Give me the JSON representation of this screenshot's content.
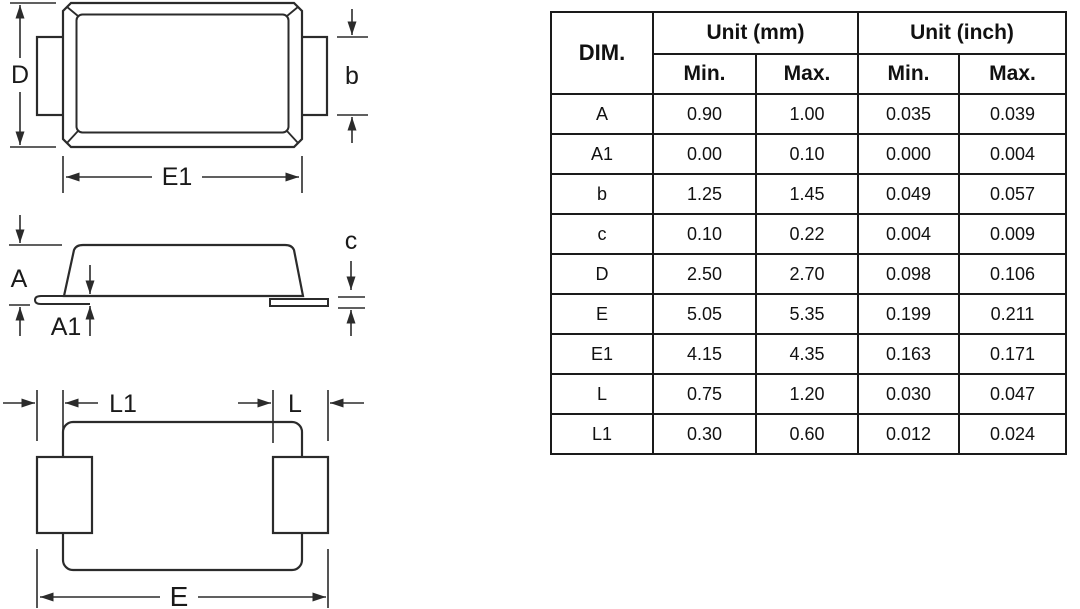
{
  "colors": {
    "line": "#2b2b2b",
    "text": "#1a1a1a",
    "background": "#ffffff"
  },
  "views": {
    "top": {
      "label_d": "D",
      "label_b": "b",
      "label_e1": "E1"
    },
    "side": {
      "label_a": "A",
      "label_a1": "A1",
      "label_c": "c"
    },
    "bottom": {
      "label_l1": "L1",
      "label_l": "L",
      "label_e": "E"
    }
  },
  "table": {
    "header": {
      "dim": "DIM.",
      "unit_mm": "Unit (mm)",
      "unit_inch": "Unit (inch)",
      "min_mm": "Min.",
      "max_mm": "Max.",
      "min_inch": "Min.",
      "max_inch": "Max."
    },
    "rows": [
      {
        "dim": "A",
        "mm_min": "0.90",
        "mm_max": "1.00",
        "in_min": "0.035",
        "in_max": "0.039"
      },
      {
        "dim": "A1",
        "mm_min": "0.00",
        "mm_max": "0.10",
        "in_min": "0.000",
        "in_max": "0.004"
      },
      {
        "dim": "b",
        "mm_min": "1.25",
        "mm_max": "1.45",
        "in_min": "0.049",
        "in_max": "0.057"
      },
      {
        "dim": "c",
        "mm_min": "0.10",
        "mm_max": "0.22",
        "in_min": "0.004",
        "in_max": "0.009"
      },
      {
        "dim": "D",
        "mm_min": "2.50",
        "mm_max": "2.70",
        "in_min": "0.098",
        "in_max": "0.106"
      },
      {
        "dim": "E",
        "mm_min": "5.05",
        "mm_max": "5.35",
        "in_min": "0.199",
        "in_max": "0.211"
      },
      {
        "dim": "E1",
        "mm_min": "4.15",
        "mm_max": "4.35",
        "in_min": "0.163",
        "in_max": "0.171"
      },
      {
        "dim": "L",
        "mm_min": "0.75",
        "mm_max": "1.20",
        "in_min": "0.030",
        "in_max": "0.047"
      },
      {
        "dim": "L1",
        "mm_min": "0.30",
        "mm_max": "0.60",
        "in_min": "0.012",
        "in_max": "0.024"
      }
    ]
  }
}
